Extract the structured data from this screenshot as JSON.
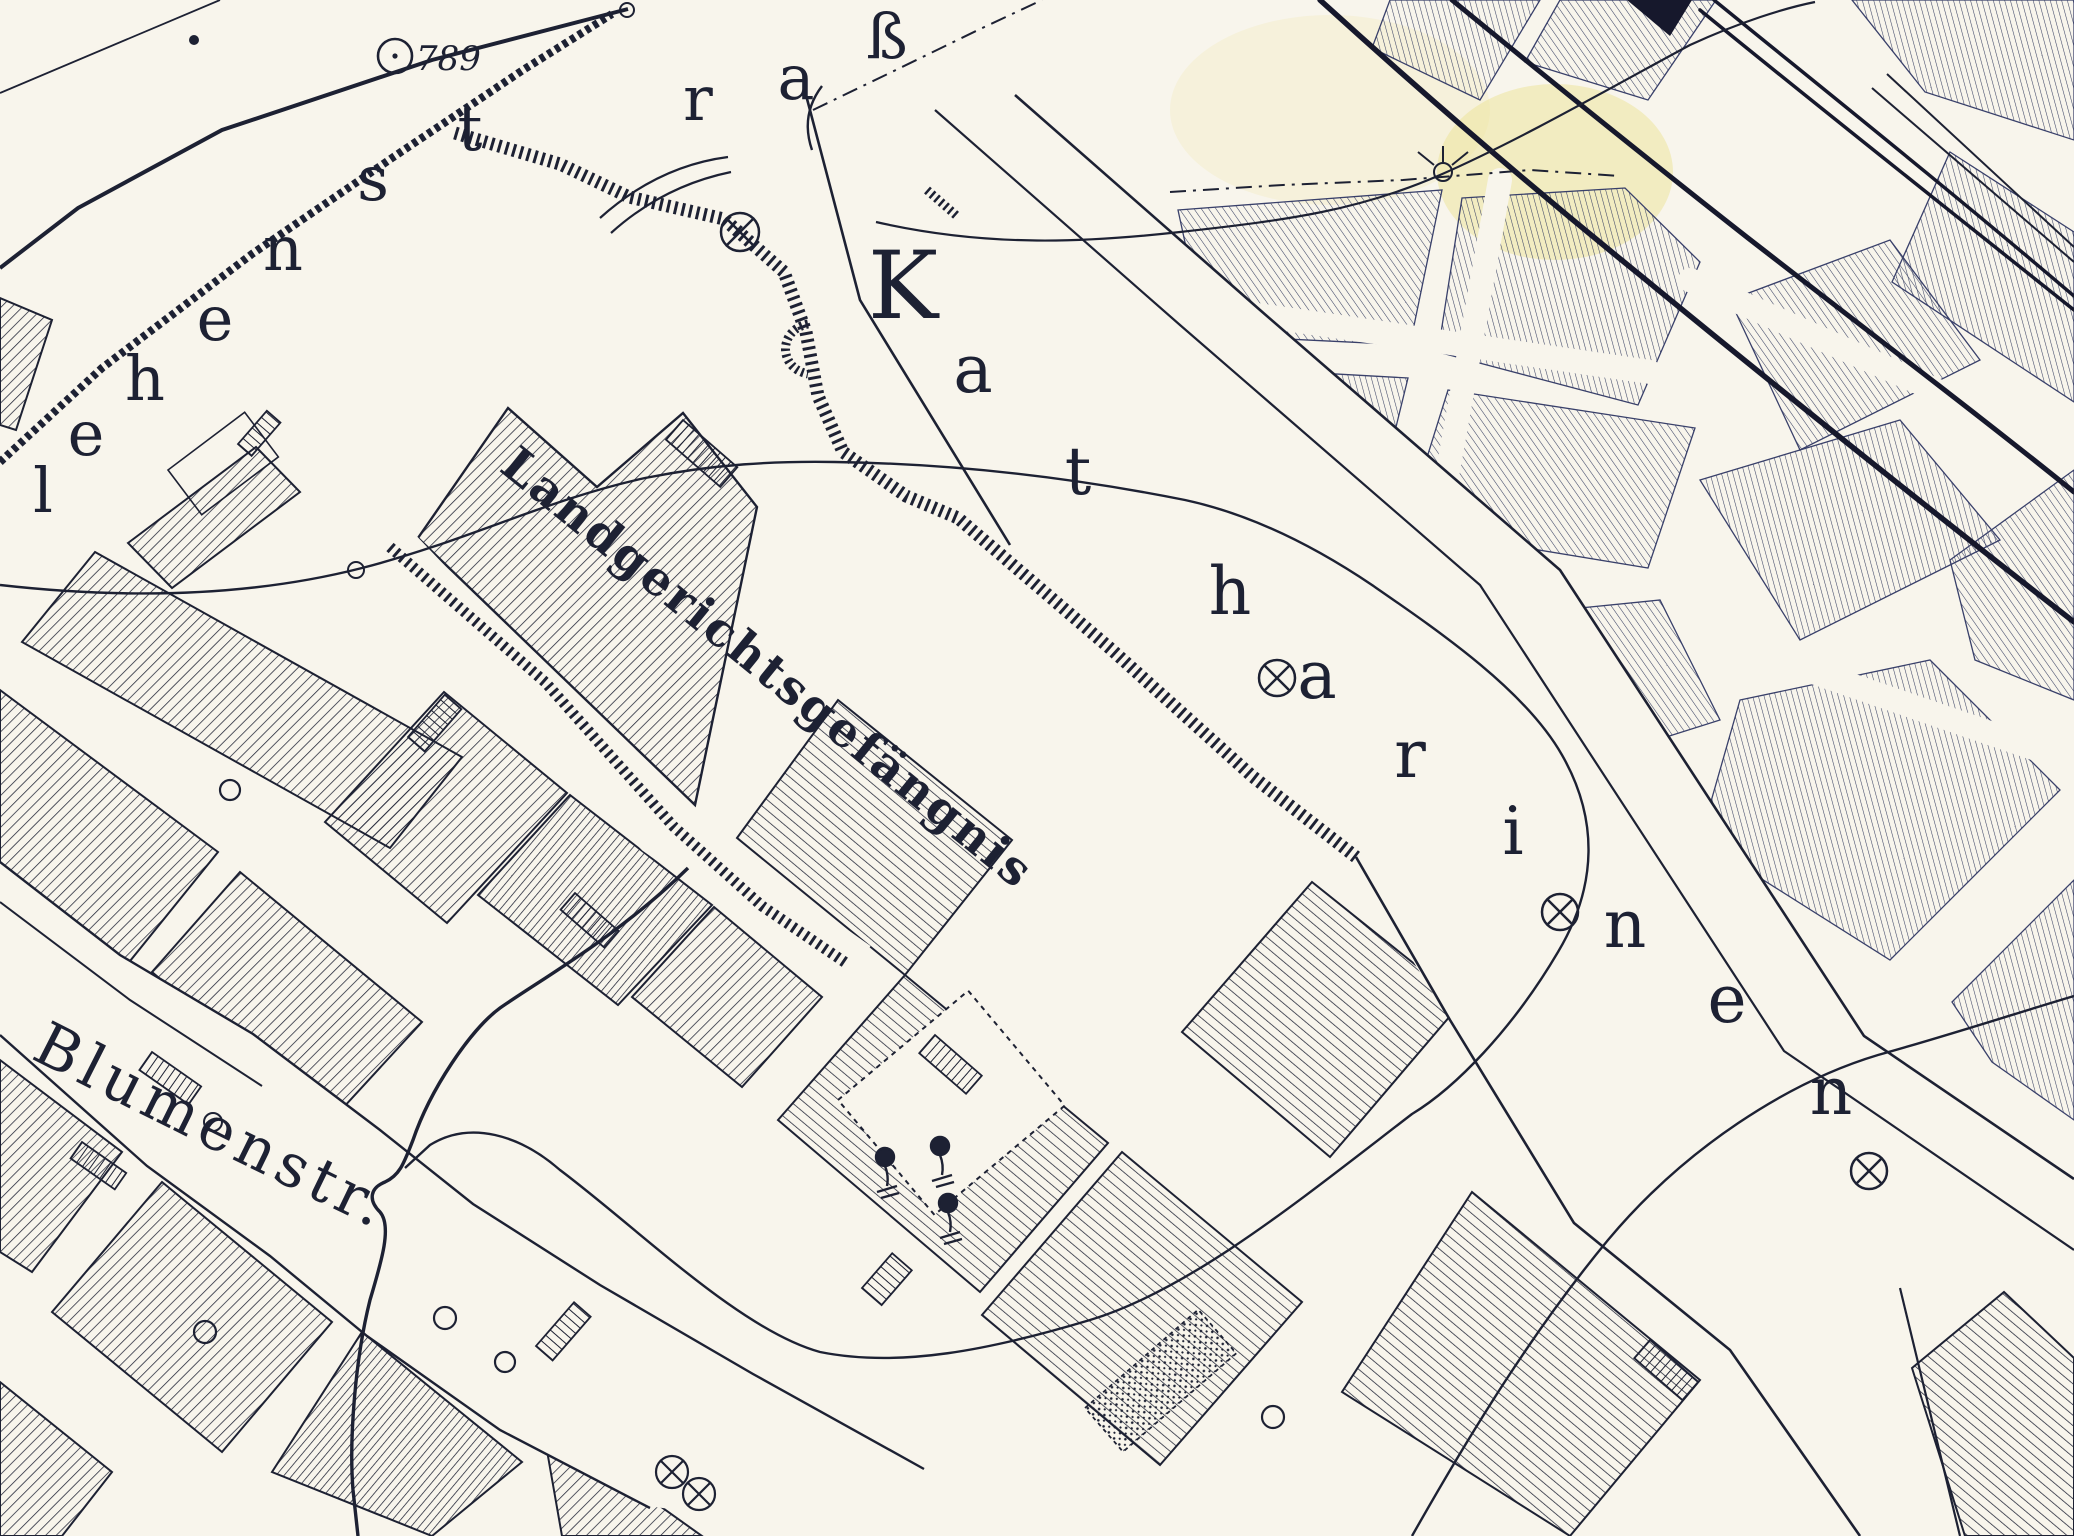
{
  "map": {
    "title": "historical city cadastral map sheet",
    "labels": {
      "prison": "Landgerichtsgefängnis",
      "elevation_value": "789",
      "street_blumen": "Blumenstr.",
      "street_katharinen_letters": [
        "K",
        "a",
        "t",
        "h",
        "a",
        "r",
        "i",
        "n",
        "e",
        "n"
      ],
      "street_lehen_letters": [
        "l",
        "e",
        "h",
        "e",
        "n",
        "s",
        "t",
        "r",
        "a",
        "ß"
      ]
    },
    "colors": {
      "paper": "#f8f5ec",
      "ink": "#1d2133",
      "fine_ink": "#3a4264",
      "highlight": "#ece28f"
    }
  }
}
